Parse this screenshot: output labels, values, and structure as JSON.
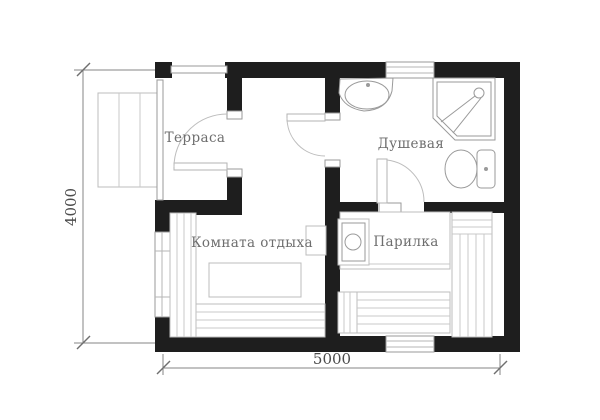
{
  "diagram": {
    "type": "floor-plan",
    "rooms": {
      "terrace": {
        "label": "Терраса"
      },
      "shower": {
        "label": "Душевая"
      },
      "lounge": {
        "label": "Комната отдыха"
      },
      "steam": {
        "label": "Парилка"
      }
    },
    "dimensions": {
      "vertical": "4000",
      "horizontal": "5000"
    },
    "fixtures": [
      "steps-icon",
      "window-icon",
      "door-icon",
      "sink-icon",
      "shower-cabin-icon",
      "toilet-icon",
      "stove-icon",
      "firebox-icon",
      "bench-icon",
      "table-icon"
    ],
    "colors": {
      "wall": "#1e1e1e",
      "furniture_line": "#bcbcbc",
      "fixture_line": "#9a9a9a",
      "label_text": "#6e6e6e",
      "dimension_line": "#858585",
      "dimension_text": "#4c4c4c",
      "background": "#ffffff"
    }
  }
}
